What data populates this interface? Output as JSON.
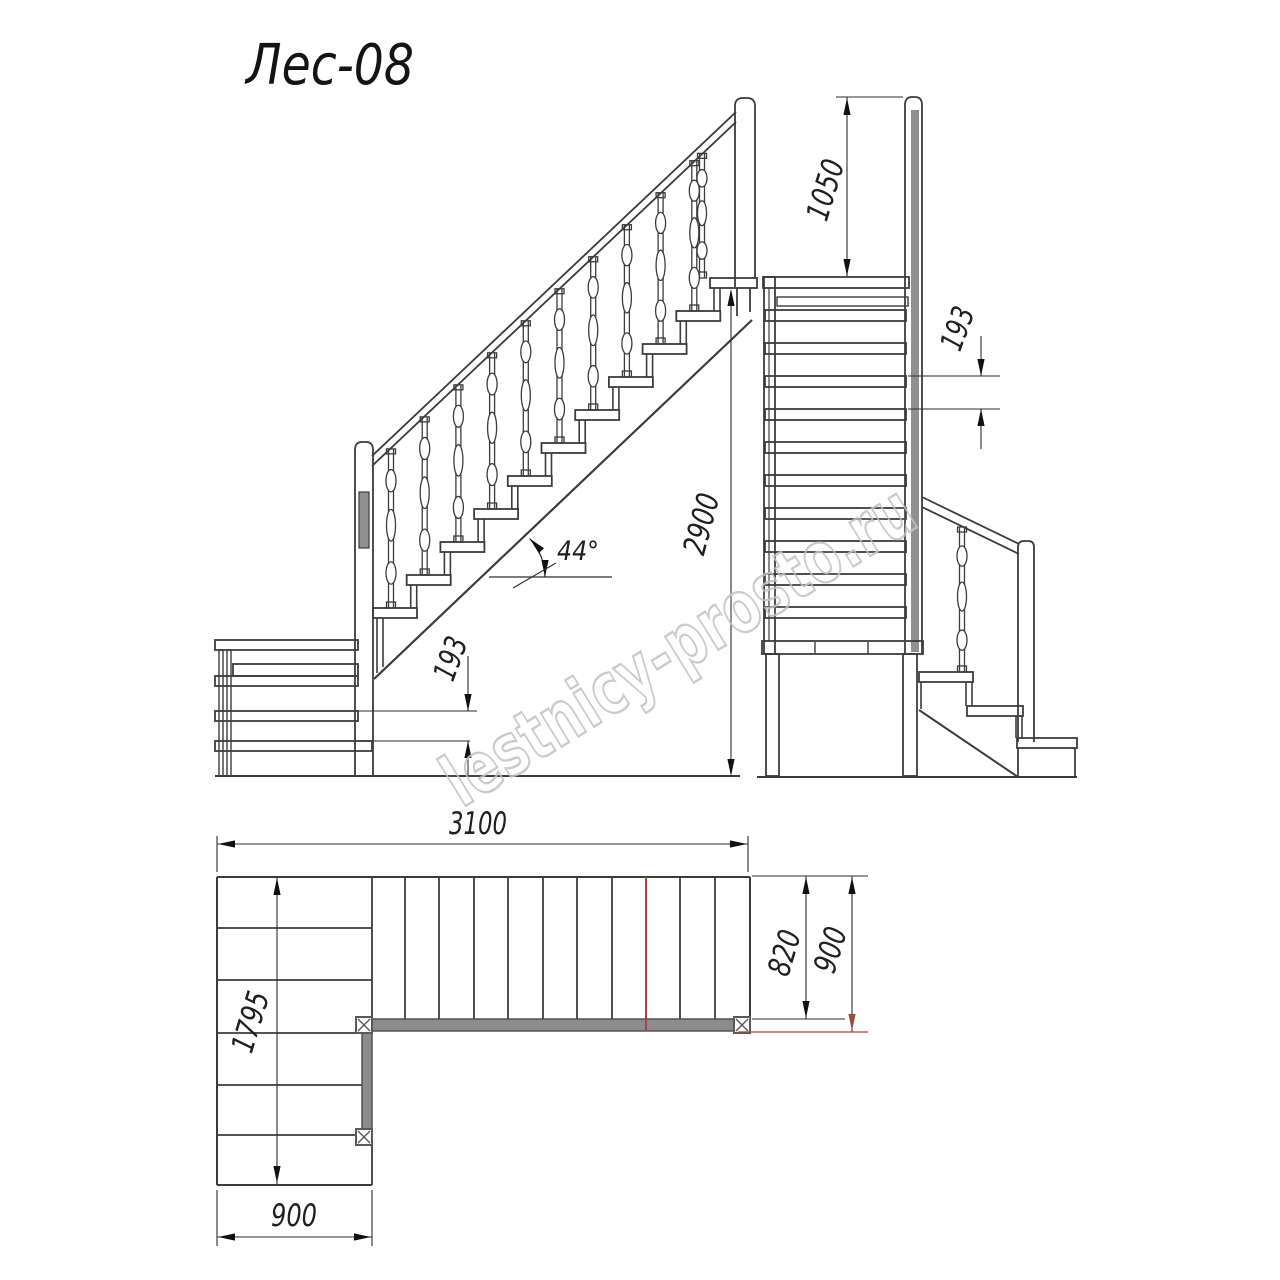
{
  "title": "Лес-08",
  "watermark": "lestnicy-prosto.ru",
  "views": {
    "side": {
      "label": "side-elevation",
      "total_height": "2900",
      "riser_height": "193",
      "stair_angle": "44°"
    },
    "front": {
      "label": "front-elevation",
      "handrail_height": "1050",
      "riser_height": "193"
    },
    "plan": {
      "label": "plan-view",
      "total_length": "3100",
      "lower_flight_length": "1795",
      "lower_flight_width": "900",
      "flight_clear_width": "820",
      "flight_overall_width": "900"
    }
  },
  "colors": {
    "line": "#3c3c3c",
    "dim_line": "#2e2e2e",
    "arrow": "#111111",
    "accent": "#a04a3c",
    "fill_gray": "#8c8c8c",
    "post_gray": "#909090",
    "watermark": "#c3c3c3",
    "background": "#ffffff"
  }
}
